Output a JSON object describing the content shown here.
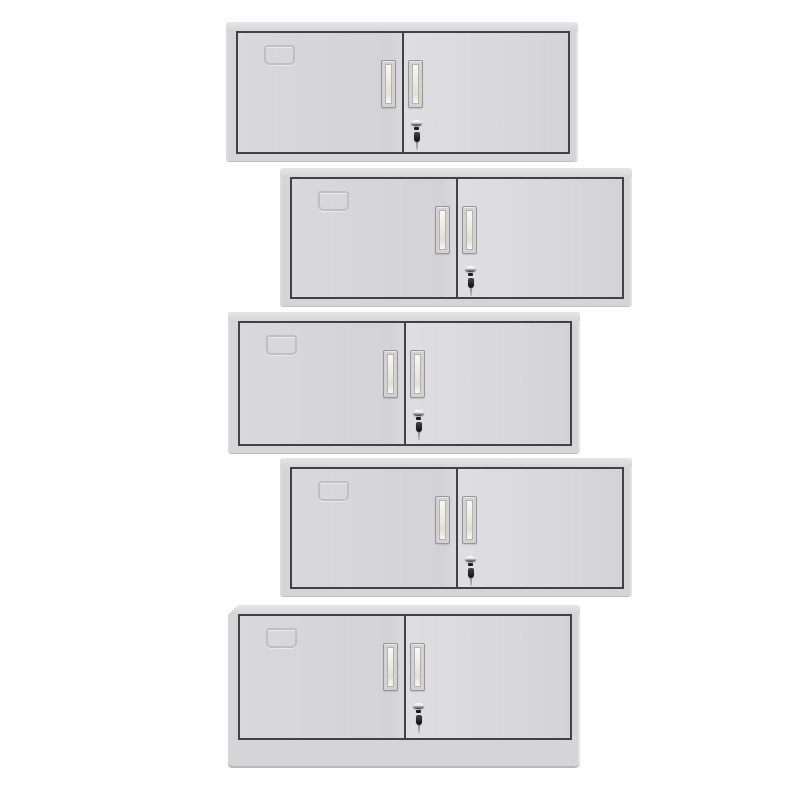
{
  "scene": {
    "title": "Product photo: five stacked light-gray steel two-door office cabinets, alternately offset left and right on a white background",
    "background": "#ffffff",
    "canvas": {
      "width": 800,
      "height": 800
    }
  },
  "colors": {
    "background": "#ffffff",
    "frame": "#d5d5d7",
    "top_strip": "#e6e6e8",
    "door_face": "#d9d9db",
    "door_face_dark": "#d3d3d5",
    "door_face_light": "#dedee0",
    "outline": "#424244",
    "label_outline": "#bcbcbe",
    "handle_flange": "#d2d2d4",
    "handle_border": "#96969a",
    "handle_recess_edge": "#b4b4ae",
    "handle_recess_light": "#f8f7f1",
    "handle_recess_mid": "#edebe0",
    "handle_recess_dark": "#e2e0d3",
    "lock_chrome_light": "#ffffff",
    "lock_chrome_dark": "#6d6d71",
    "lock_body": "#1c1c1e",
    "key_color": "#232327"
  },
  "cabinet_defaults": {
    "width": 352,
    "door_inset_bottom": 8
  },
  "cabinets": [
    {
      "name": "cabinet-1",
      "x": 226,
      "y": 22,
      "height": 140,
      "foot": "left"
    },
    {
      "name": "cabinet-2",
      "x": 280,
      "y": 168,
      "height": 139,
      "foot": "right"
    },
    {
      "name": "cabinet-3",
      "x": 228,
      "y": 312,
      "height": 142,
      "foot": "none"
    },
    {
      "name": "cabinet-4",
      "x": 280,
      "y": 458,
      "height": 139,
      "foot": "right"
    },
    {
      "name": "cabinet-5",
      "x": 228,
      "y": 605,
      "height": 163,
      "foot": "none",
      "plinth_height": 28,
      "beveled_top_left": true
    }
  ],
  "cabinet_parts": {
    "top_panel": "cabinet-top-panel",
    "left_door": "left-door",
    "right_door": "right-door",
    "label_slot": "label-card-slot",
    "left_handle": "left-door-handle",
    "right_handle": "right-door-handle",
    "lock": "keyhole-lock",
    "key": "key-in-lock",
    "foot": "cabinet-side-foot",
    "plinth": "base-plinth"
  }
}
